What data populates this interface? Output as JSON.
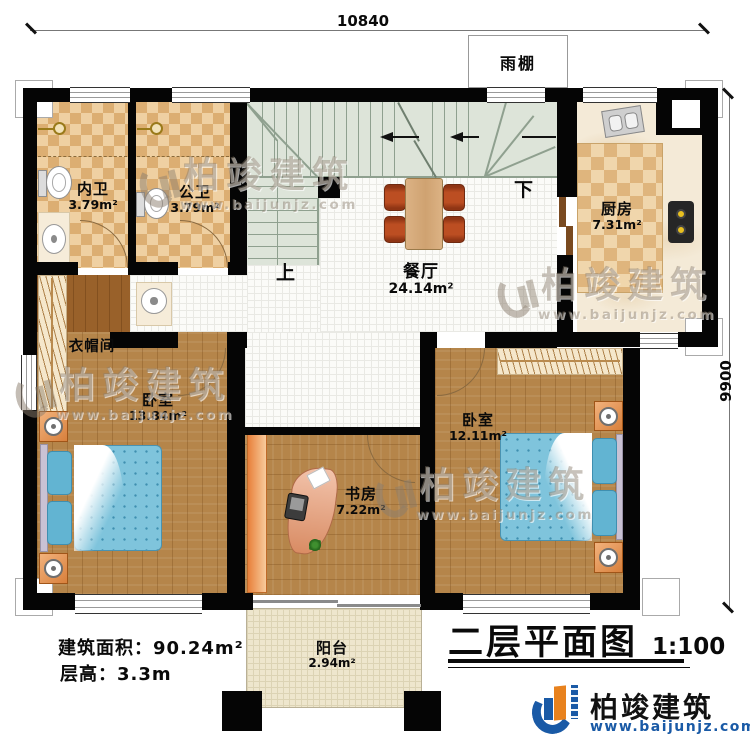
{
  "dimensions": {
    "width": "10840",
    "height": "9900"
  },
  "canopy": {
    "label": "雨棚"
  },
  "stairs": {
    "up": "上",
    "down": "下"
  },
  "rooms": {
    "bath_inner": {
      "name": "内卫",
      "area": "3.79m²"
    },
    "bath_public": {
      "name": "公卫",
      "area": "3.79m²"
    },
    "kitchen": {
      "name": "厨房",
      "area": "7.31m²"
    },
    "dining": {
      "name": "餐厅",
      "area": "24.14m²"
    },
    "cloakroom": {
      "name": "衣帽间"
    },
    "bedroom_left": {
      "name": "卧室",
      "area": "13.84m²"
    },
    "bedroom_right": {
      "name": "卧室",
      "area": "12.11m²"
    },
    "study": {
      "name": "书房",
      "area": "7.22m²"
    },
    "balcony": {
      "name": "阳台",
      "area": "2.94m²"
    }
  },
  "notes": {
    "floor_area": "建筑面积：90.24m²",
    "floor_height": "层高：3.3m"
  },
  "title": {
    "text": "二层平面图",
    "scale": "1:100"
  },
  "brand": {
    "name": "柏竣建筑",
    "url": "www.baijunjz.com",
    "blue": "#1a5aa6",
    "orange": "#e8821e"
  },
  "watermark": {
    "name": "柏竣建筑",
    "url": "www.baijunjz.com"
  },
  "colors": {
    "wall": "#050505",
    "stair": "#dde4d9",
    "tile_floor": "#fbfbf8",
    "wood_floor": "#b5854a",
    "bed_blue": "#7fc4dc"
  }
}
